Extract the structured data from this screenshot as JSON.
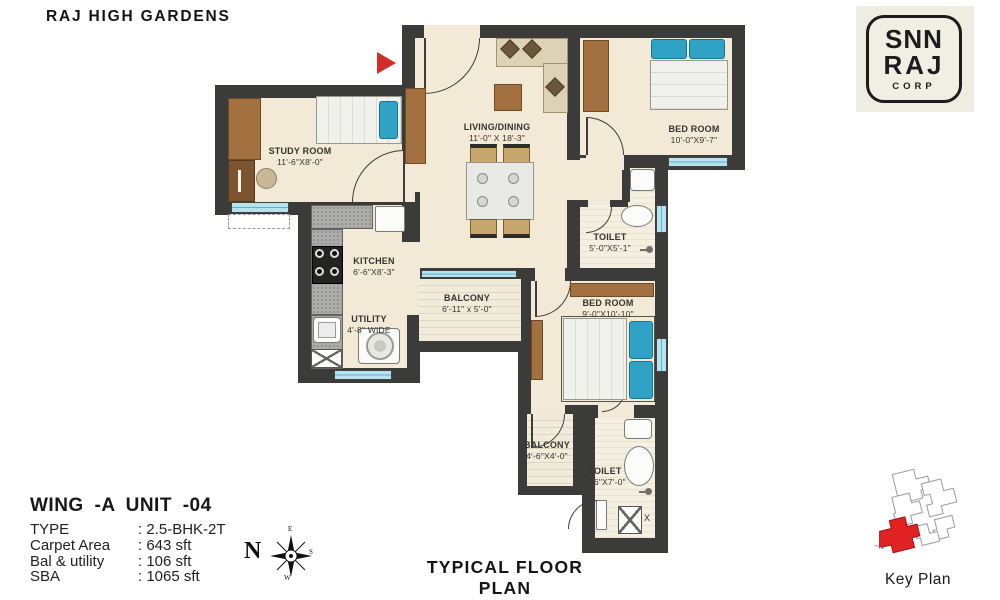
{
  "title": "RAJ HIGH GARDENS",
  "plan_caption": "TYPICAL FLOOR PLAN",
  "logo": {
    "top": "SNN",
    "middle": "RAJ",
    "bottom": "CORP"
  },
  "compass": {
    "north": "N",
    "east": "E",
    "south": "S",
    "west": "W"
  },
  "key_plan": {
    "label": "Key Plan"
  },
  "shaft_label": "X",
  "unit_info": {
    "heading": "WING -A  UNIT -04",
    "sep": ":",
    "rows": [
      {
        "label": "TYPE",
        "value": "2.5-BHK-2T"
      },
      {
        "label": "Carpet Area",
        "value": "643 sft"
      },
      {
        "label": "Bal & utility",
        "value": "106 sft"
      },
      {
        "label": "SBA",
        "value": "1065 sft"
      }
    ]
  },
  "rooms": [
    {
      "name": "STUDY ROOM",
      "dims": "11'-6\"X8'-0\""
    },
    {
      "name": "LIVING/DINING",
      "dims": "11'-0\" X 18'-3\""
    },
    {
      "name": "BED ROOM",
      "dims": "10'-0\"X9'-7\""
    },
    {
      "name": "TOILET",
      "dims": "5'-0\"X5'-1\""
    },
    {
      "name": "KITCHEN",
      "dims": "6'-6\"X8'-3\""
    },
    {
      "name": "UTILITY",
      "dims": "4'-8\" WIDE"
    },
    {
      "name": "BALCONY",
      "dims": "6'-11\" x 5'-0\""
    },
    {
      "name": "BED ROOM",
      "dims": "9'-0\"X10'-10\""
    },
    {
      "name": "BALCONY",
      "dims": "4'-6\"X4'-0\""
    },
    {
      "name": "TOILET",
      "dims": "4'-6\"X7'-0\""
    }
  ],
  "colors": {
    "wall": "#3b3b39",
    "floor": "#f2e9d7",
    "window_blue": "#b7e2ee",
    "wood": "#a2713f",
    "bed_blue": "#2fa2c6",
    "entrance_red": "#d22d27",
    "key_plan_red": "#e02222"
  }
}
